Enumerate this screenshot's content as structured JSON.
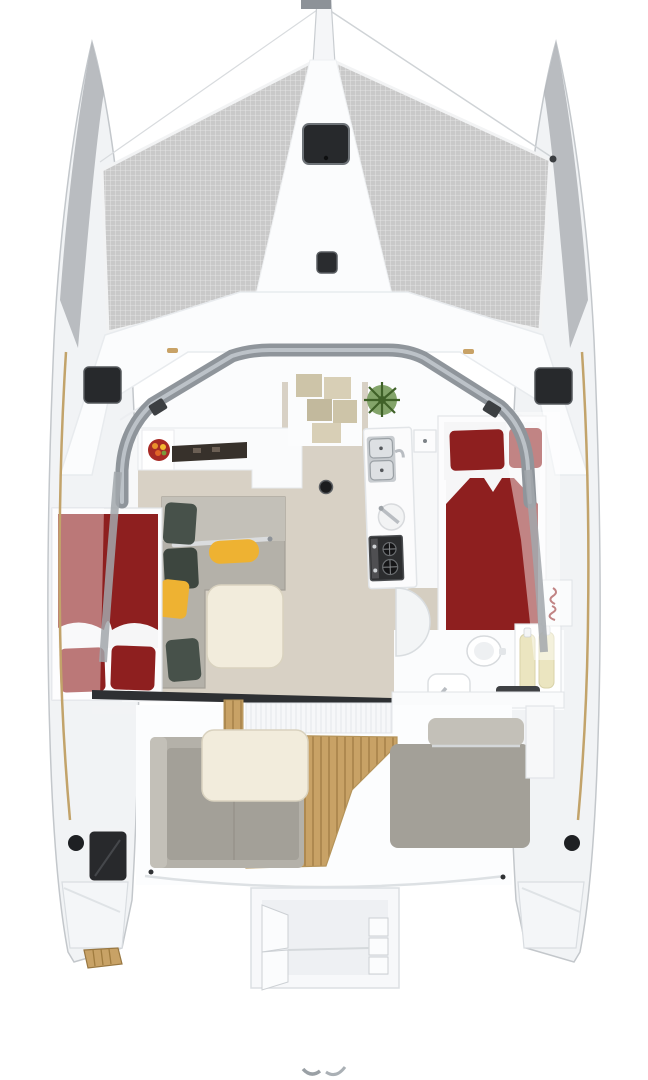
{
  "scene": {
    "title": "Catamaran interior layout – top view render",
    "view": "top-down cutaway floor plan",
    "canvas": {
      "width": 648,
      "height": 1080
    }
  },
  "regions": {
    "boat": "Sailing catamaran top view floor plan",
    "bowsprit": "Bowsprit and anchor roller",
    "rigging": "Forestay rigging lines",
    "trampoline_left": "Port bow trampoline net",
    "trampoline_right": "Starboard bow trampoline net",
    "foredeck": "Foredeck and coachroof",
    "deck_hatch_large": "Large foredeck hatch",
    "deck_hatch_small": "Small foredeck hatch",
    "side_hatch_port": "Port side deck hatch",
    "side_hatch_starboard": "Starboard side deck hatch",
    "windscreen_arch": "Coachroof windscreen arch",
    "salon": "Salon with L-shaped sofa and table",
    "galley_counter": "Aft galley counter with fruit bowl",
    "galley_island": "Galley island with sink and stove",
    "storage_steps": "Forward storage cubby steps",
    "plant": "Green plant",
    "mast_post": "Compression post fitting",
    "cabin_starboard": "Starboard double cabin with red bedding",
    "cabin_port": "Port hull double berth with red bedding",
    "bathroom": "Starboard aft bathroom with toilet and sink",
    "sliding_door": "Aft sliding door sill",
    "cockpit": "Aft cockpit with teak floor",
    "cockpit_sofa": "Cockpit L-shaped sofa with table",
    "cockpit_bench": "Aft cockpit bench",
    "transom_port": "Port transom steps",
    "transom_starboard": "Starboard transom steps",
    "swim_platform": "Central swim / dinghy platform",
    "hull_window": "Port hull window",
    "porthole": "Hull porthole"
  },
  "palette": {
    "page_bg": "#ffffff",
    "hull_fill": "#f1f3f5",
    "hull_edge": "#c3c7cb",
    "hull_shadow": "#b2b6ba",
    "deck_white": "#fbfcfd",
    "deck_line": "#e2e5e8",
    "mesh_base": "#c9c9c9",
    "mesh_line": "#e9e9e9",
    "arch_gray": "#8f959b",
    "arch_light": "#bcc2c8",
    "hatch_dark": "#27292c",
    "floor_beige": "#d8d1c5",
    "counter_dark": "#37312b",
    "cubby_tan": "#cdc4a8",
    "cubby_tan_light": "#d8cfb6",
    "plant_dark": "#3f6128",
    "plant_light": "#6d9450",
    "red_fabric": "#8e1f1f",
    "red_plate": "#a82a25",
    "yellow_cushion": "#eeb232",
    "sofa_gray": "#b4b1a9",
    "sofa_gray_light": "#c3c0b8",
    "sofa_gray_dark": "#a3a098",
    "pillow_charcoal": "#47514a",
    "table_cream": "#f2ecdc",
    "table_edge": "#d9d2bf",
    "teak": "#c8a266",
    "teak_line": "#a8834a",
    "steel": "#b9bdc2",
    "steel_dark": "#8d9298",
    "stove_dark": "#2c2d2f",
    "bottle_yellow": "#ebe5c0",
    "glass_tint": "rgba(255,255,255,0.45)"
  }
}
